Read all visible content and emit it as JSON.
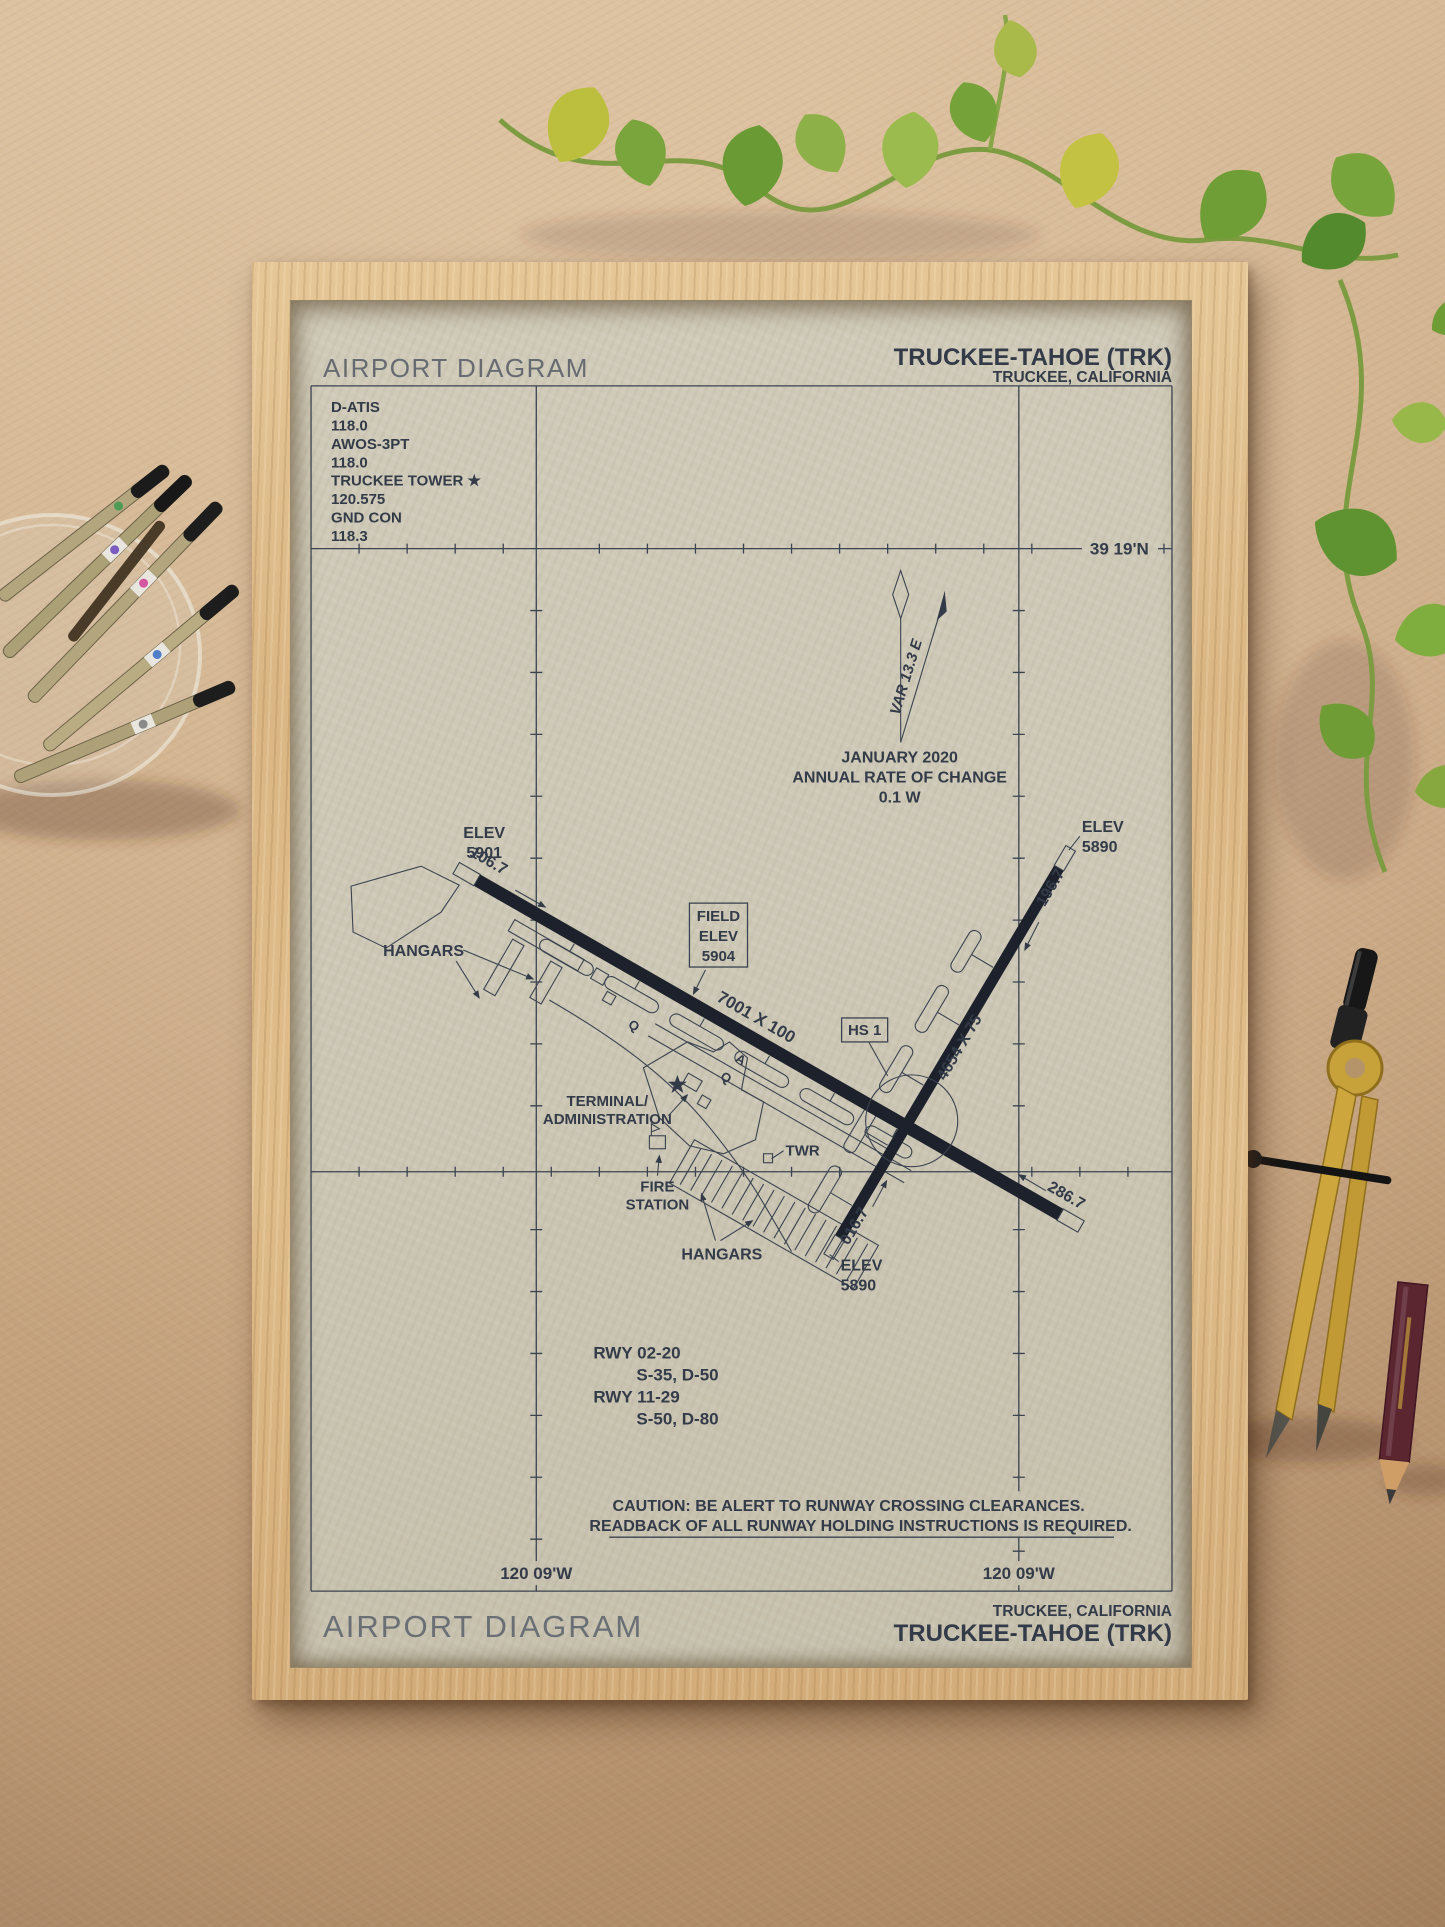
{
  "header": {
    "title": "AIRPORT DIAGRAM",
    "airport": "TRUCKEE-TAHOE (TRK)",
    "city": "TRUCKEE, CALIFORNIA"
  },
  "freq": [
    "D-ATIS",
    "118.0",
    "AWOS-3PT",
    "118.0",
    "TRUCKEE TOWER ★",
    "120.575",
    "GND CON",
    "118.3"
  ],
  "grid": {
    "lat": "39 19'N",
    "lon_left": "120 09'W",
    "lon_right": "120 09'W"
  },
  "compass": {
    "var": "VAR 13.3  E",
    "jan": "JANUARY 2020",
    "rate": "ANNUAL RATE OF CHANGE",
    "rate_val": "0.1  W"
  },
  "field": {
    "f1": "FIELD",
    "f2": "ELEV",
    "f3": "5904"
  },
  "rwy": {
    "dim1129": "7001 X 100",
    "dim0220": "4654 X 75",
    "h11": "106.7",
    "h29": "286.7",
    "h20": "196.7",
    "h02": "016.7"
  },
  "elev": {
    "e11a": "ELEV",
    "e11b": "5901",
    "e20a": "ELEV",
    "e20b": "5890",
    "e02a": "ELEV",
    "e02b": "5890"
  },
  "hs1": {
    "label": "HS 1"
  },
  "bldg": {
    "hang_u": "HANGARS",
    "hang_l": "HANGARS",
    "term1": "TERMINAL/",
    "term2": "ADMINISTRATION",
    "twr": "TWR",
    "fire1": "FIRE",
    "fire2": "STATION"
  },
  "taxi": {
    "q1": "Q",
    "q2": "Q",
    "a1": "A"
  },
  "info": [
    "RWY 02-20",
    "S-35, D-50",
    "RWY 11-29",
    "S-50, D-80"
  ],
  "caution": {
    "line1": "CAUTION: BE ALERT TO RUNWAY CROSSING CLEARANCES.",
    "line2": "READBACK OF ALL RUNWAY HOLDING INSTRUCTIONS IS REQUIRED."
  },
  "footer": {
    "title": "AIRPORT DIAGRAM",
    "city": "TRUCKEE, CALIFORNIA",
    "airport": "TRUCKEE-TAHOE (TRK)"
  },
  "colors": {
    "ink": "#333b49",
    "runway": "#1d212b",
    "paper": "#cdc8b6",
    "frame_wood": "#dab684",
    "cardboard": "#c3a07c",
    "leaf_green": "#6f9c35",
    "leaf_yellow": "#c4c243",
    "brass": "#c7a23b"
  }
}
